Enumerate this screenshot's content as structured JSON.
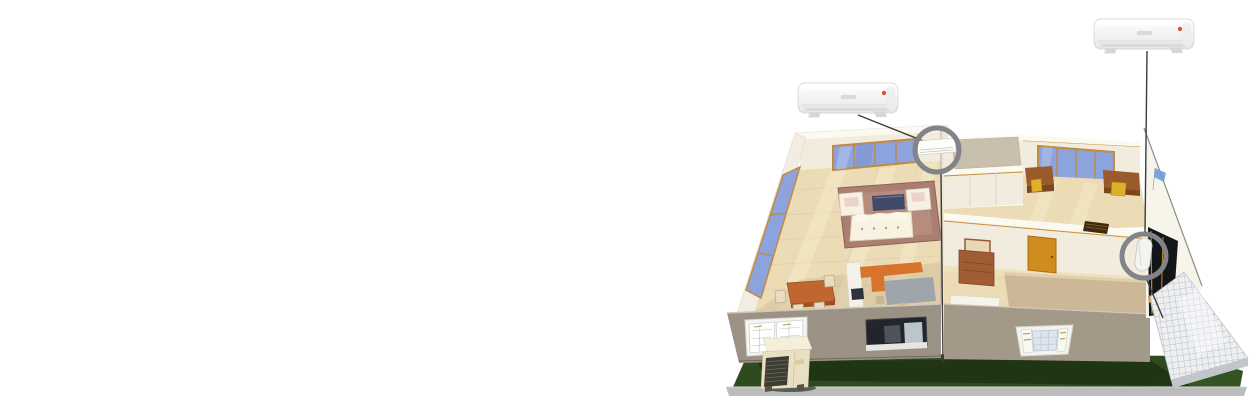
{
  "canvas": {
    "width": 1256,
    "height": 401,
    "background": "#ffffff"
  },
  "illustration": {
    "kind": "isometric-cutaway-house-air-conditioning-layout",
    "rooms": [
      "living-room",
      "dining-kitchen",
      "hallway",
      "office",
      "bedroom",
      "terrace"
    ],
    "equipment": {
      "indoor_units_installed": 2,
      "outdoor_units": 1,
      "product_callouts": 2,
      "highlight_circles": 2
    },
    "callouts": {
      "left_product_unit": {
        "icon": "split-ac-indoor-unit-icon",
        "indicator": "red-status-light",
        "logo": "brand-logo"
      },
      "right_product_unit": {
        "icon": "split-ac-indoor-unit-icon",
        "indicator": "red-status-light",
        "logo": "brand-logo"
      }
    },
    "colors": {
      "lawn_green": "#2e4b1f",
      "lawn_shadow": "#1b2f12",
      "curb_gray": "#bcbcbc",
      "wall_cream": "#f1ecdd",
      "wall_white": "#fbf9f0",
      "trim_orange": "#c8913c",
      "glass_blue": "#8da3dd",
      "window_frame": "#c28a3e",
      "floor_beige": "#ecdcb6",
      "floor_tan": "#c9b493",
      "front_wall_gray": "#9b9285",
      "rug_mauve": "#aa7f72",
      "sofa_cream": "#f7f2e2",
      "table_slate": "#3e4a67",
      "wood_orange": "#c0662f",
      "counter_orange": "#d8732b",
      "kitchen_gray": "#9aa3ab",
      "desk_brown": "#9a5a2b",
      "chair_yellow": "#dfb02a",
      "door_amber": "#cf8d1f",
      "dresser_brown": "#a05c33",
      "terrace_tile": "#edeff1",
      "tile_line": "#a9aeb5",
      "outdoor_unit_beige": "#e9dfc2",
      "grille_dark": "#3c3c33",
      "indicator_red": "#e05038",
      "highlight_circle": "#838489",
      "connector_line": "#3c3c3c",
      "emblem_blue": "#6d9bd8"
    }
  }
}
